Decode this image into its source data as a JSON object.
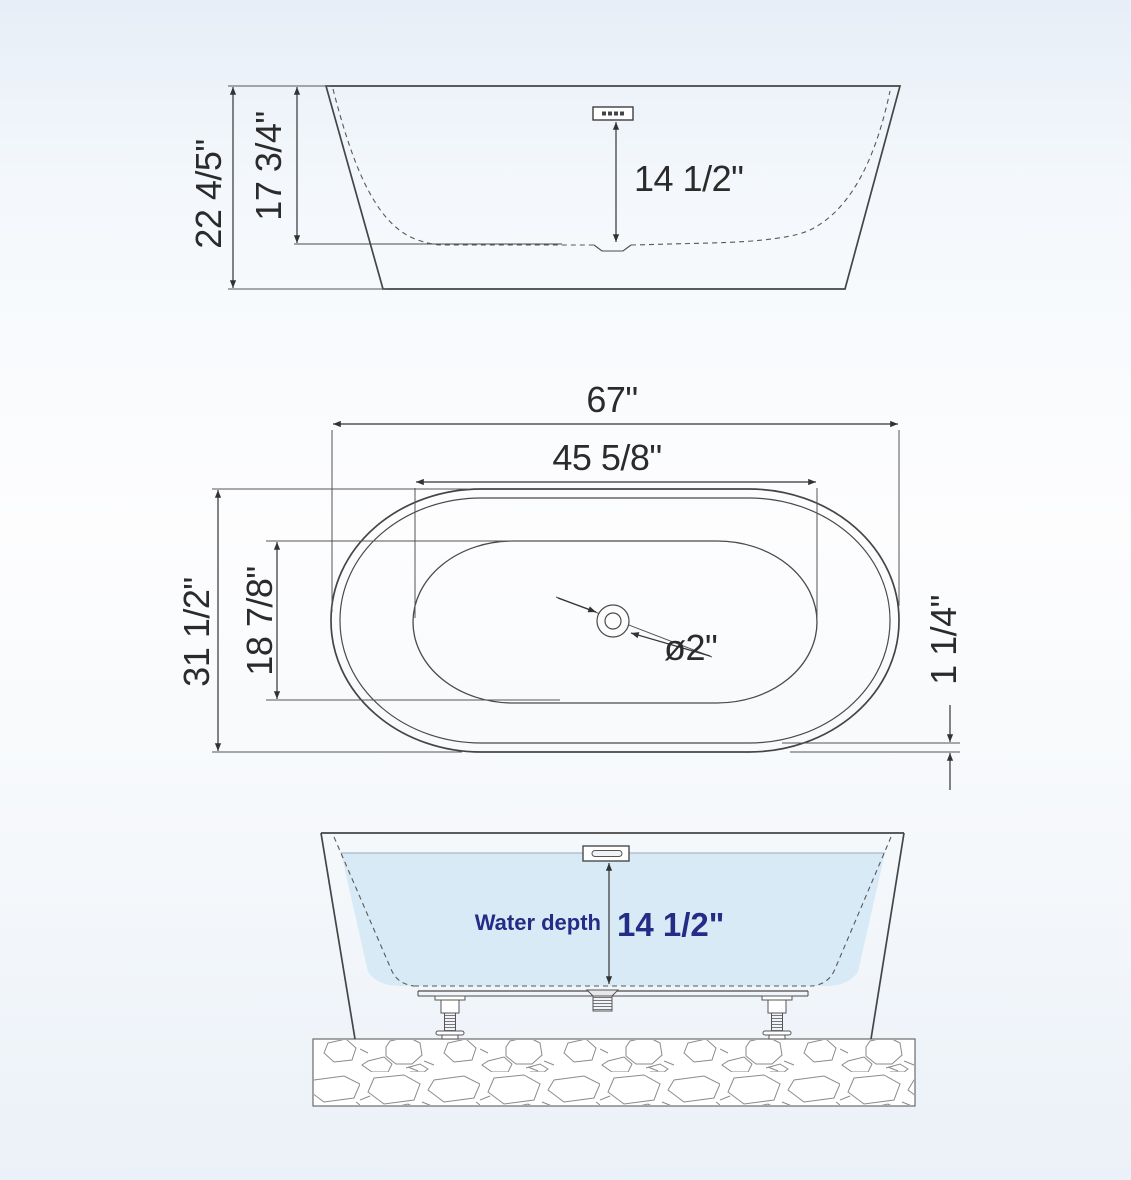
{
  "colors": {
    "accent_navy": "#232d85",
    "water_fill": "#d9eaf7",
    "drawing_line": "#4a4a4a",
    "dimension_line": "#333333",
    "background_top": "#e7eef7",
    "background_bottom": "#ebf1f8"
  },
  "side_view": {
    "overall_height": "22 4/5\"",
    "interior_depth": "17 3/4\"",
    "overflow_height": "14 1/2\""
  },
  "plan_view": {
    "overall_length": "67\"",
    "interior_length": "45 5/8\"",
    "overall_width": "31 1/2\"",
    "interior_width": "18 7/8\"",
    "drain_diameter": "ø2\"",
    "rim_thickness": "1 1/4\""
  },
  "section_view": {
    "water_depth_label": "Water depth",
    "water_depth_value": "14 1/2\""
  }
}
